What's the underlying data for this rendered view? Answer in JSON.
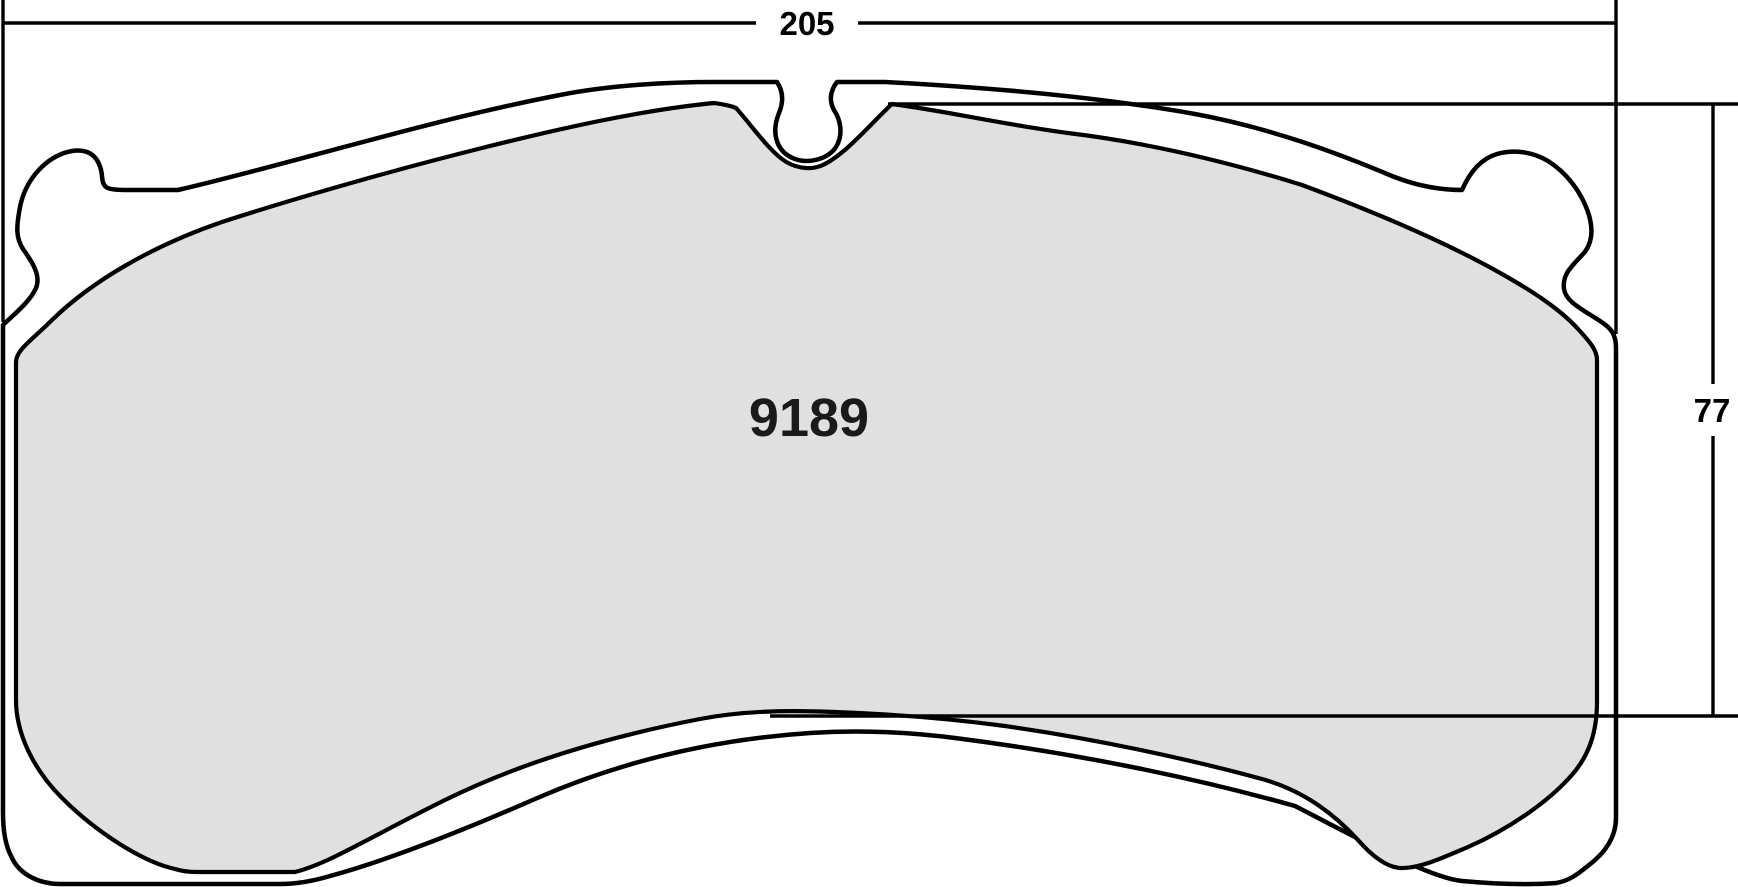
{
  "diagram": {
    "type": "brake-pad-technical-drawing",
    "part_number_label": "9189",
    "width_dimension_label": "205",
    "height_dimension_label": "77"
  },
  "colors": {
    "friction_fill": "#e0e0e0",
    "plate_fill": "#ffffff",
    "line": "#000000",
    "background": "#ffffff"
  }
}
